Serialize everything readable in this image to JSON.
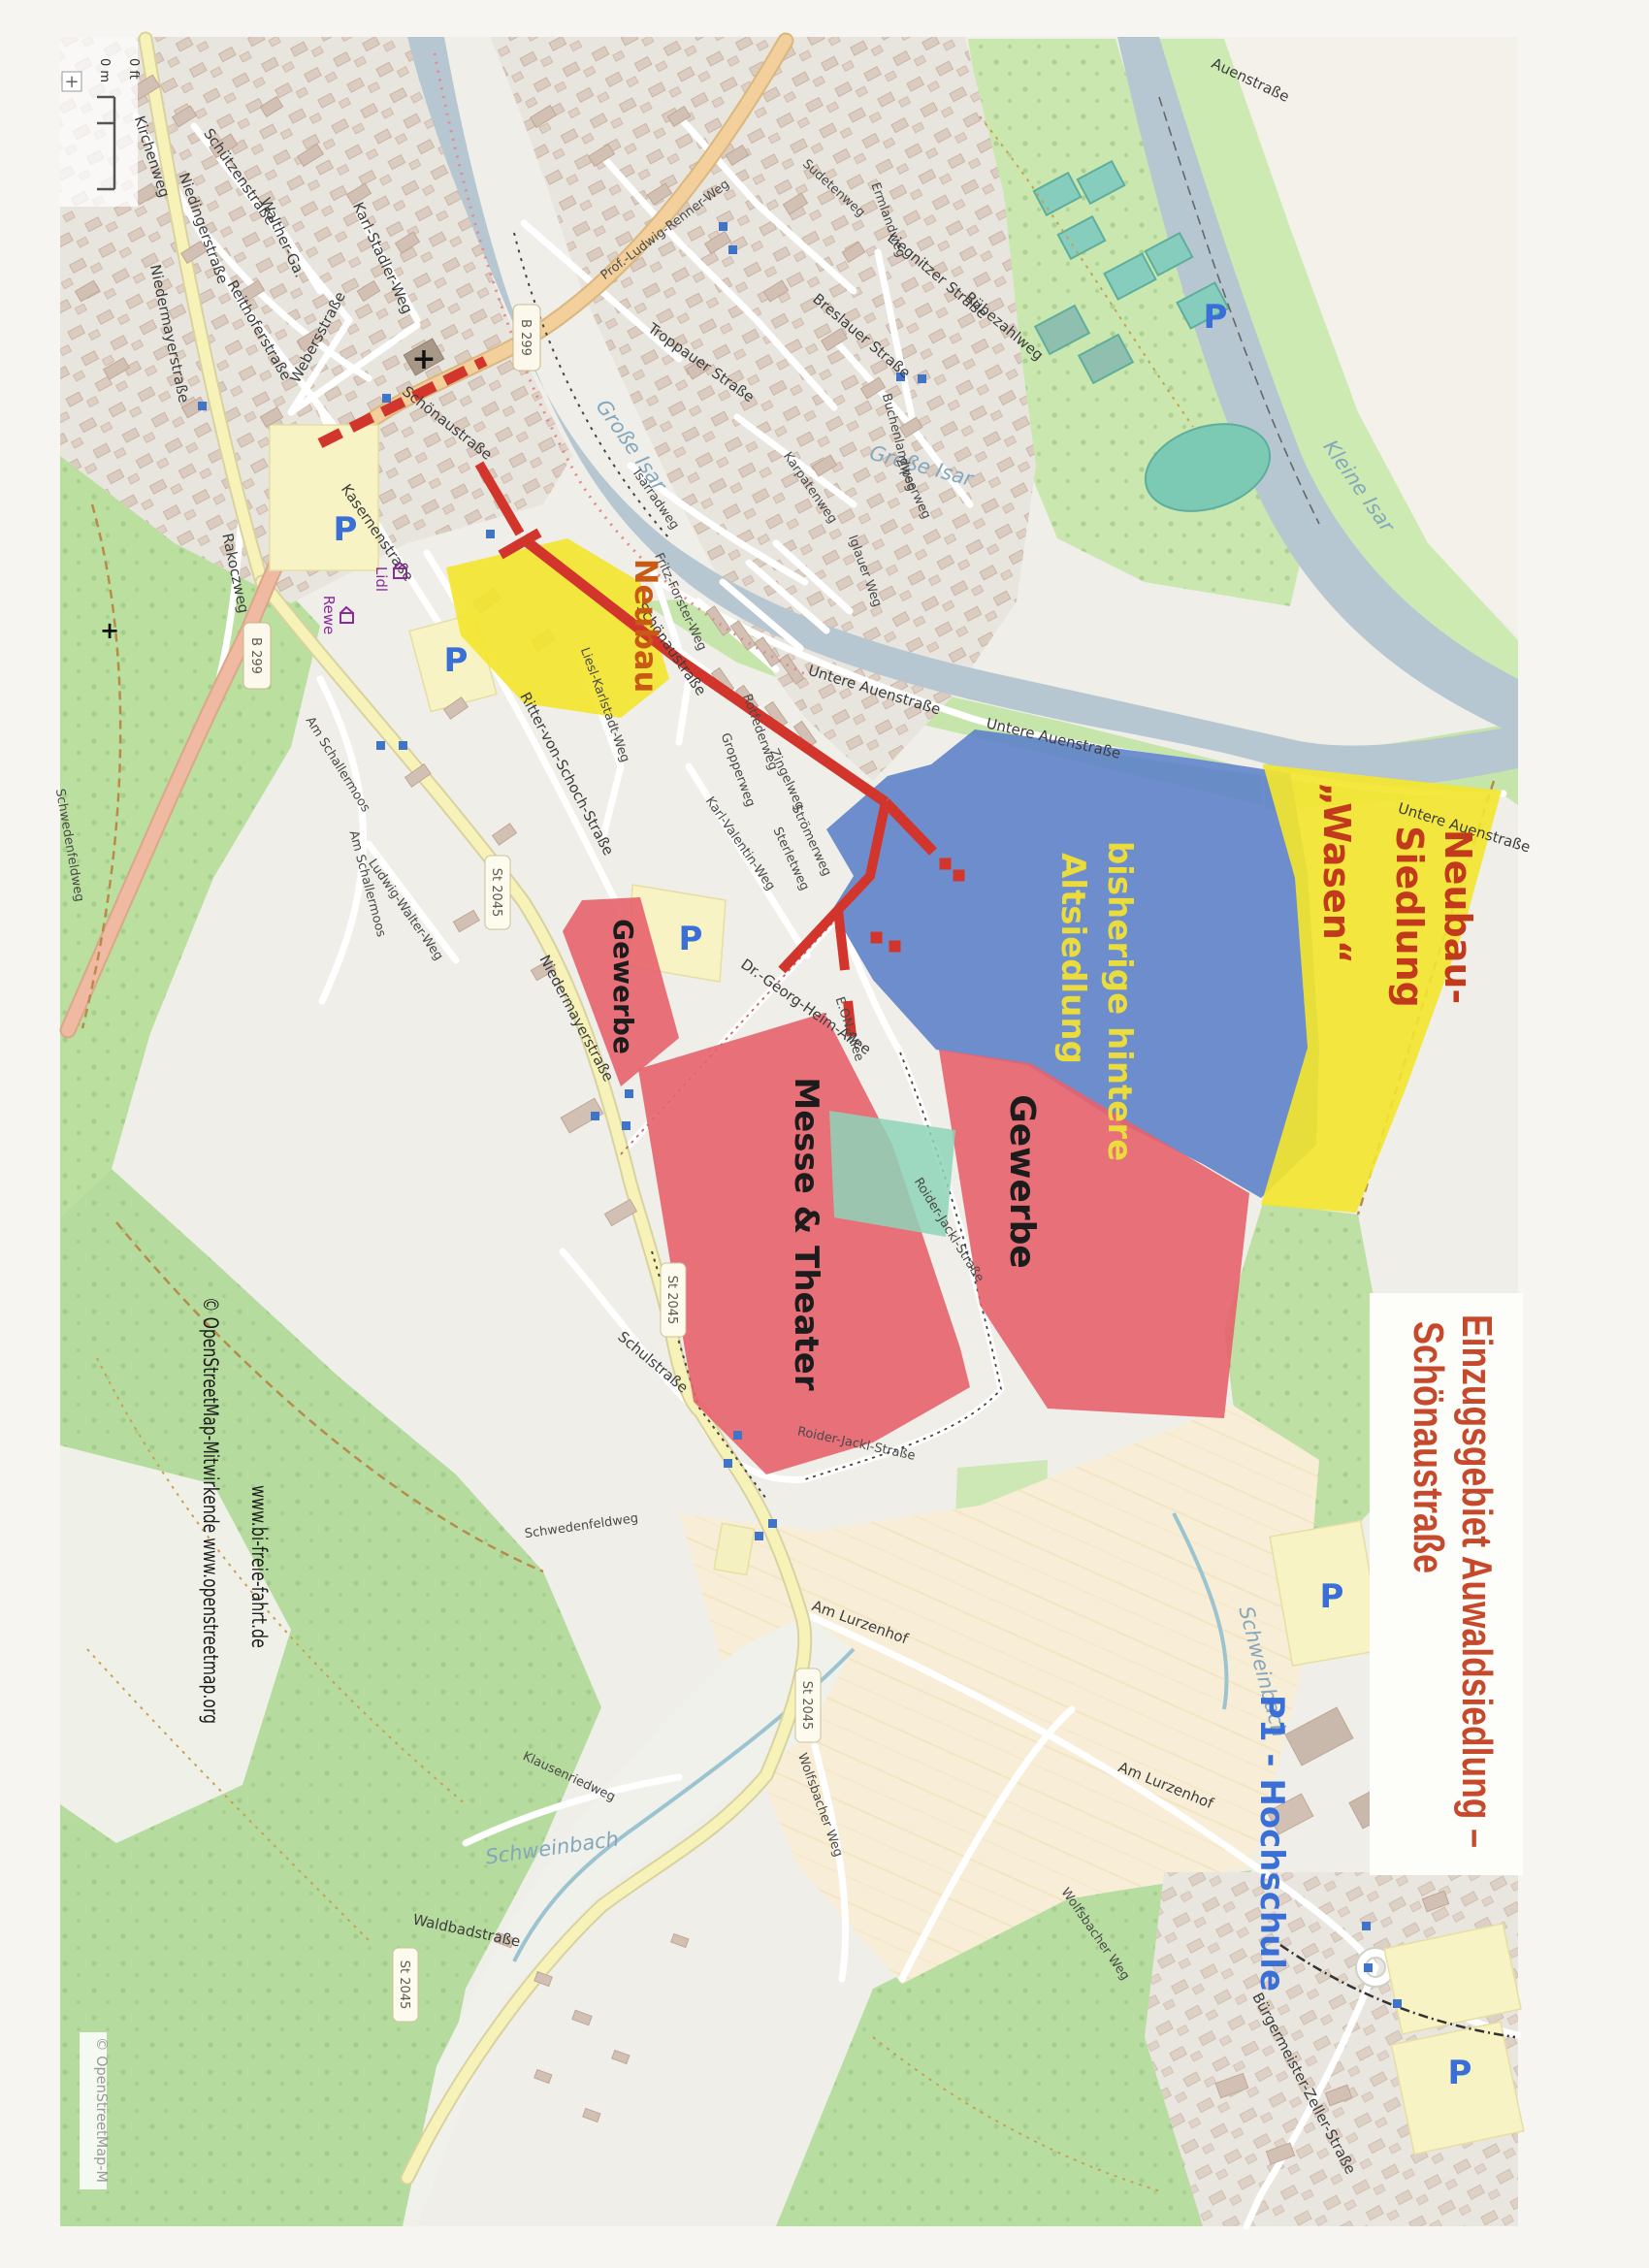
{
  "title": {
    "line1": "Einzugsgebiet Auwaldsiedlung –",
    "line2": "Schönaustraße",
    "color": "#c7492c"
  },
  "attribution": {
    "osm_full": "© OpenStreetMap-Mitwirkende  www.openstreetmap.org",
    "campaign": "www.bi-freie-fahrt.de",
    "corner": "© OpenStreetMap-M"
  },
  "scalebar": {
    "metric": "0 m",
    "imperial": "0 ft",
    "zoom_in": "+"
  },
  "zones": {
    "neubau": {
      "label": "Neubau",
      "fill": "#f3e52f",
      "label_color": "#c85a15"
    },
    "altsiedlung": {
      "line1": "bisherige hintere",
      "line2": "Altsiedlung",
      "fill": "#5b80c8",
      "label_color": "#e9dc3c"
    },
    "wasen": {
      "line1": "Neubau-",
      "line2": "Siedlung",
      "line3": "„Wasen“",
      "fill": "#f3e52f",
      "label_color": "#c13a1c"
    },
    "messe": {
      "label": "Messe & Theater",
      "fill": "#e7626d",
      "label_color": "#1c1c1c"
    },
    "gewerbe_west": {
      "label": "Gewerbe",
      "fill": "#e7626d",
      "label_color": "#1c1c1c"
    },
    "gewerbe_ost": {
      "label": "Gewerbe",
      "fill": "#e7626d",
      "label_color": "#1c1c1c"
    }
  },
  "road_badges": [
    {
      "label": "B 299"
    },
    {
      "label": "B 299"
    },
    {
      "label": "St 2045"
    },
    {
      "label": "St 2045"
    },
    {
      "label": "St 2045"
    },
    {
      "label": "St 2045"
    }
  ],
  "water_labels": [
    {
      "label": "Große Isar"
    },
    {
      "label": "Große Isar"
    },
    {
      "label": "Kleine Isar"
    },
    {
      "label": "Schweinbach"
    },
    {
      "label": "Schweinbach"
    }
  ],
  "streets": [
    {
      "label": "Niedermayerstraße"
    },
    {
      "label": "Kirchenweg"
    },
    {
      "label": "Schützenstraße"
    },
    {
      "label": "Niedingerstraße"
    },
    {
      "label": "Reithoferstraße"
    },
    {
      "label": "Walther-Ga."
    },
    {
      "label": "Karl-Stadler-Weg"
    },
    {
      "label": "Webersstraße"
    },
    {
      "label": "Schönaustraße"
    },
    {
      "label": "Schönaustraße"
    },
    {
      "label": "Kasernenstraße"
    },
    {
      "label": "Rakoczweg"
    },
    {
      "label": "Fritz-Forster-Weg"
    },
    {
      "label": "Liesl-Karlstadt-Weg"
    },
    {
      "label": "Isarradweg"
    },
    {
      "label": "Untere Auenstraße"
    },
    {
      "label": "Untere Auenstraße"
    },
    {
      "label": "Untere Auenstraße"
    },
    {
      "label": "Auenstraße"
    },
    {
      "label": "Prof.-Ludwig-Renner-Weg"
    },
    {
      "label": "Troppauer Straße"
    },
    {
      "label": "Breslauer Straße"
    },
    {
      "label": "Sudetenweg"
    },
    {
      "label": "Ermlandweg"
    },
    {
      "label": "Liegnitzer Straße"
    },
    {
      "label": "Rübezahlweg"
    },
    {
      "label": "Karpatenweg"
    },
    {
      "label": "Buchenlandweg"
    },
    {
      "label": "Zipserweg"
    },
    {
      "label": "Iglauer Weg"
    },
    {
      "label": "Karl-Valentin-Weg"
    },
    {
      "label": "Rotfederweg"
    },
    {
      "label": "Gropperweg"
    },
    {
      "label": "Zingelweg"
    },
    {
      "label": "Strömerweg"
    },
    {
      "label": "Sterletweg"
    },
    {
      "label": "Ritter-von-Schoch-Straße"
    },
    {
      "label": "Am Schallermoos"
    },
    {
      "label": "Am Schallermoos"
    },
    {
      "label": "Ludwig-Walter-Weg"
    },
    {
      "label": "Niedermayerstraße"
    },
    {
      "label": "Dr.-Georg-Heim-Allee"
    },
    {
      "label": "E.ON-Allee"
    },
    {
      "label": "Roider-Jackl-Straße"
    },
    {
      "label": "Roider-Jackl-Straße"
    },
    {
      "label": "Schulstraße"
    },
    {
      "label": "Am Lurzenhof"
    },
    {
      "label": "Am Lurzenhof"
    },
    {
      "label": "Wolfsbacher Weg"
    },
    {
      "label": "Wolfsbacher Weg"
    },
    {
      "label": "Klausenriedweg"
    },
    {
      "label": "Waldbadstraße"
    },
    {
      "label": "Bürgermeister-Zeller-Straße"
    },
    {
      "label": "Schwedenfeldweg"
    },
    {
      "label": "Schwedenfeldweg"
    }
  ],
  "pois": {
    "lidl": "Lidl",
    "rewe": "Rewe",
    "parking": "P",
    "hochschule_parking": "P1 - Hochschule"
  }
}
